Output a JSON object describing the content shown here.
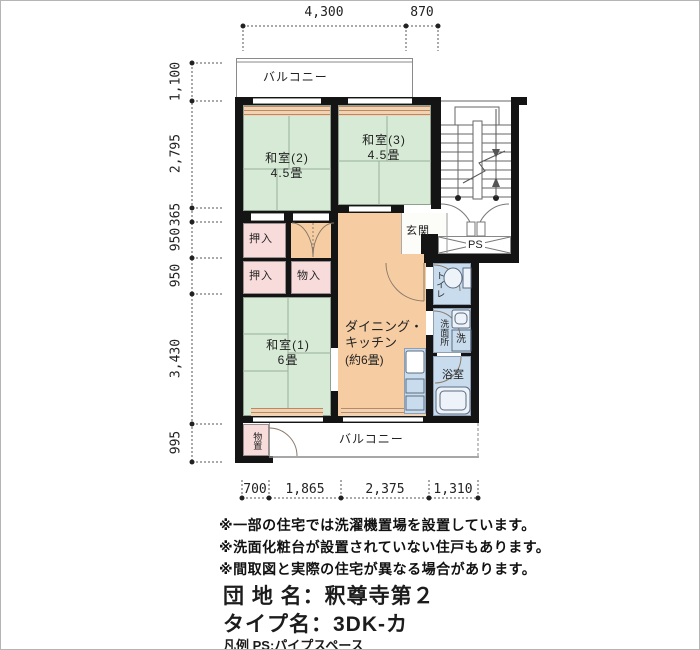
{
  "colors": {
    "tatami": "#d6ead6",
    "closet": "#f8dbdb",
    "dk": "#f6cda3",
    "water": "#c9dcee",
    "wall": "#141414",
    "band": "#f0d3b4",
    "bandline": "#bb8860"
  },
  "dims": {
    "top": [
      "4,300",
      "870"
    ],
    "left": [
      "1,100",
      "2,795",
      "365",
      "950",
      "950",
      "3,430",
      "995"
    ],
    "bottom": [
      "700",
      "1,865",
      "2,375",
      "1,310"
    ]
  },
  "labels": {
    "balcony_top": "バルコニー",
    "balcony_bottom": "バルコニー",
    "washitsu2_name": "和室(2)",
    "washitsu2_size": "4.5畳",
    "washitsu3_name": "和室(3)",
    "washitsu3_size": "4.5畳",
    "washitsu1_name": "和室(1)",
    "washitsu1_size": "6畳",
    "dk_line1": "ダイニング・",
    "dk_line2": "キッチン",
    "dk_line3": "(約6畳)",
    "oshiire_upper": "押入",
    "oshiire_lower": "押入",
    "monoire": "物入",
    "genkan": "玄関",
    "ps": "PS",
    "toilet": "トイレ",
    "senmenjo": "洗面所",
    "laundry": "洗",
    "bath": "浴室",
    "monooki": "物置"
  },
  "notes": [
    "※一部の住宅では洗濯機置場を設置しています。",
    "※洗面化粧台が設置されていない住戸もあります。",
    "※間取図と実際の住宅が異なる場合があります。"
  ],
  "titles": {
    "danchi": "団 地 名：釈尊寺第２",
    "type": "タイプ名：3DK-カ",
    "legend": "凡例 PS:パイプスペース"
  }
}
